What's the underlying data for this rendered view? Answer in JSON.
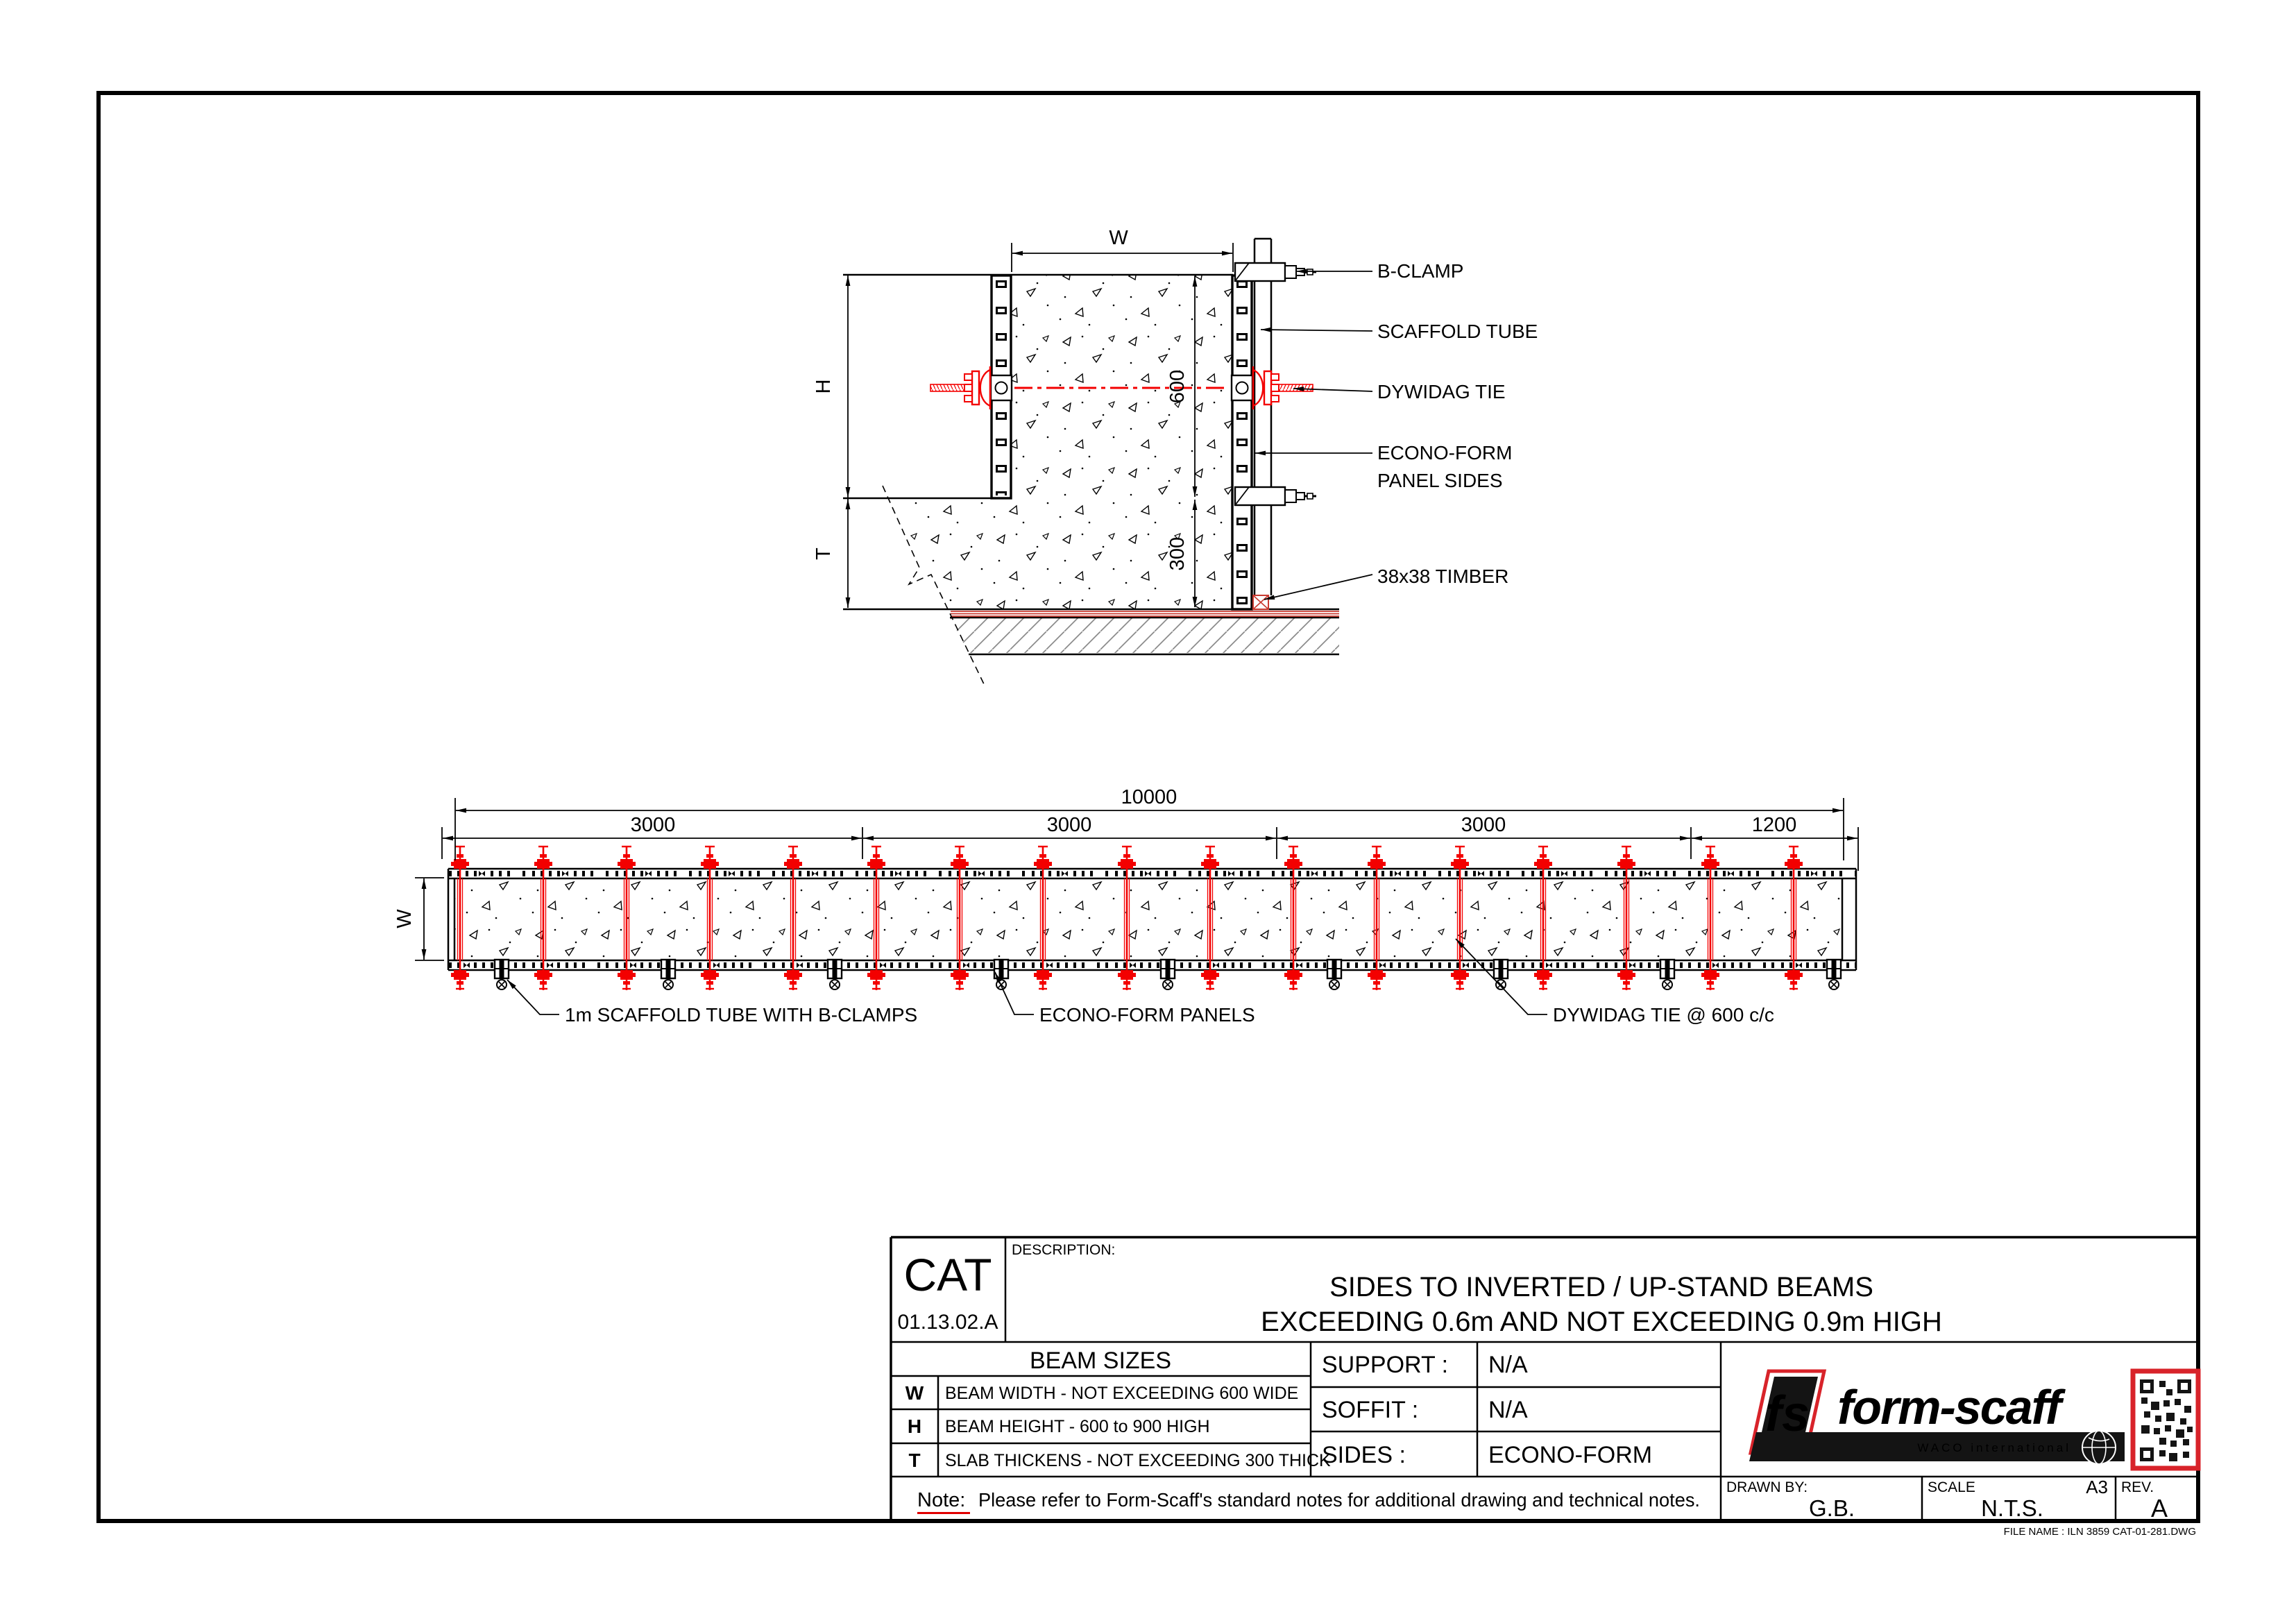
{
  "colors": {
    "draw_red": "#f30000",
    "logo_red": "#e8232a",
    "note_red": "#e00000"
  },
  "section_view": {
    "dims": {
      "w": "W",
      "h": "H",
      "t": "T",
      "beam_depth": "600",
      "slab_depth": "300"
    },
    "labels": {
      "b_clamp": "B-CLAMP",
      "scaffold_tube": "SCAFFOLD TUBE",
      "dywidag_tie": "DYWIDAG TIE",
      "econoform_line1": "ECONO-FORM",
      "econoform_line2": "PANEL SIDES",
      "timber": "38x38 TIMBER"
    }
  },
  "plan_view": {
    "dims": {
      "total": "10000",
      "segments": [
        "3000",
        "3000",
        "3000",
        "1200"
      ],
      "w": "W"
    },
    "labels": {
      "scaffold": "1m SCAFFOLD TUBE WITH B-CLAMPS",
      "panels": "ECONO-FORM PANELS",
      "ties": "DYWIDAG TIE @ 600 c/c"
    }
  },
  "title_block": {
    "cat": "CAT",
    "cat_no": "01.13.02.A",
    "description_label": "DESCRIPTION:",
    "title_line1": "SIDES TO INVERTED / UP-STAND BEAMS",
    "title_line2": "EXCEEDING 0.6m AND NOT EXCEEDING 0.9m HIGH",
    "beam_sizes": {
      "header": "BEAM SIZES",
      "rows": [
        {
          "key": "W",
          "desc": "BEAM WIDTH - NOT EXCEEDING 600 WIDE"
        },
        {
          "key": "H",
          "desc": "BEAM HEIGHT - 600 to 900 HIGH"
        },
        {
          "key": "T",
          "desc": "SLAB THICKENS - NOT EXCEEDING 300 THICK"
        }
      ]
    },
    "specs": [
      {
        "label": "SUPPORT :",
        "value": "N/A"
      },
      {
        "label": "SOFFIT :",
        "value": "N/A"
      },
      {
        "label": "SIDES :",
        "value": "ECONO-FORM"
      }
    ],
    "note_label": "Note:",
    "note_text": "Please refer to Form-Scaff's standard notes for additional drawing and technical notes.",
    "drawn_by_label": "DRAWN BY:",
    "drawn_by": "G.B.",
    "scale_label": "SCALE",
    "scale": "N.T.S.",
    "paper_size": "A3",
    "rev_label": "REV.",
    "rev": "A",
    "logo": {
      "monogram": "fs",
      "name": "form-scaff",
      "tagline": "WACO international"
    },
    "file_name": "FILE NAME : ILN 3859 CAT-01-281.DWG"
  }
}
